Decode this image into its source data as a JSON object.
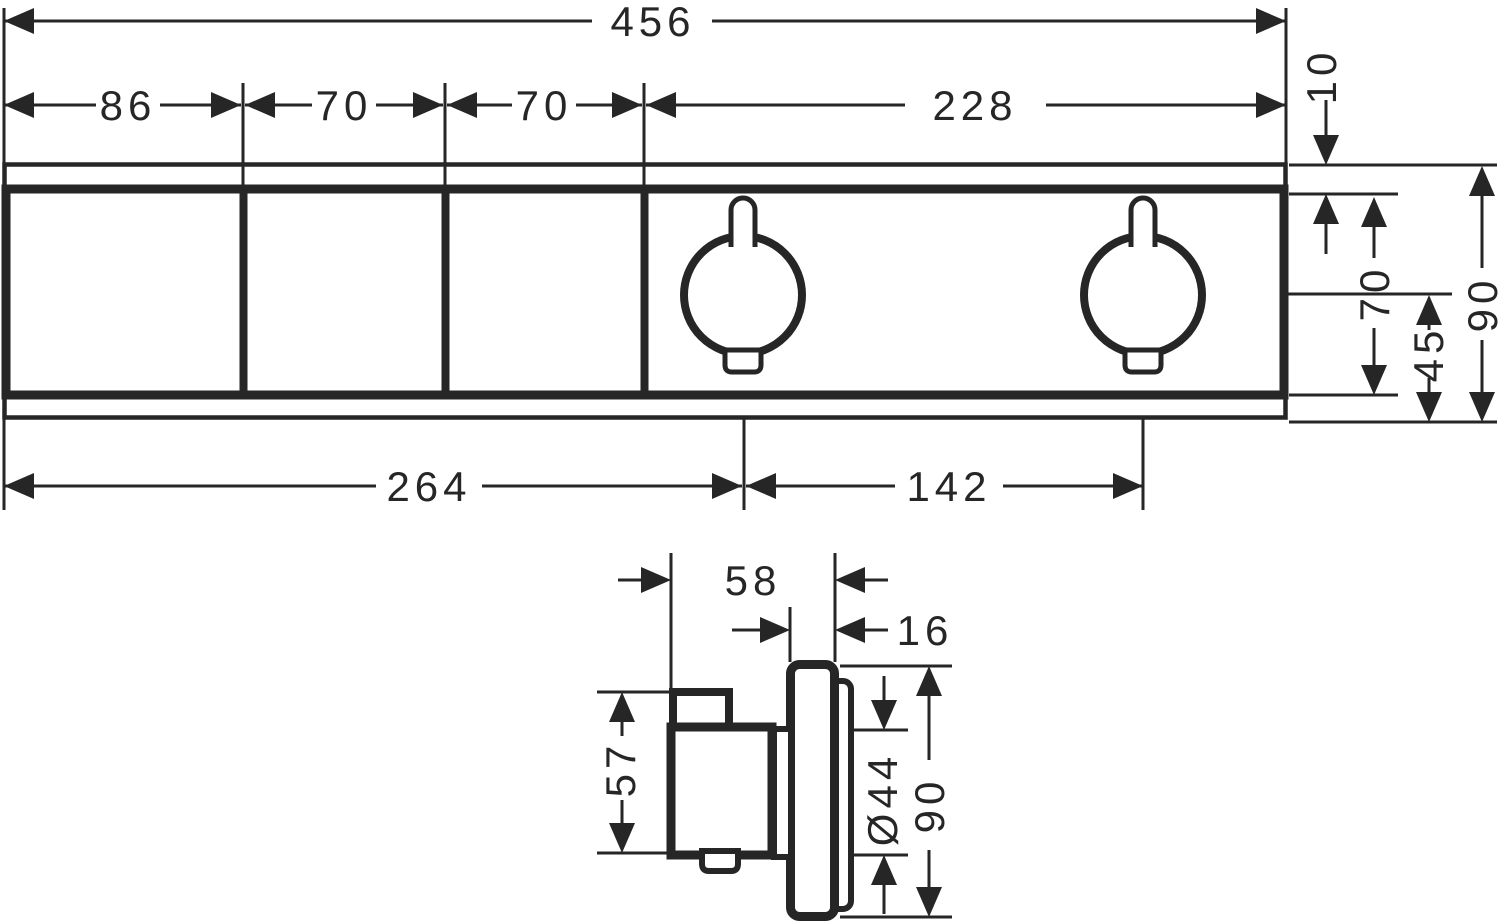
{
  "front_view": {
    "dims": {
      "overall_width": "456",
      "module_1_width": "86",
      "module_2_width": "70",
      "module_3_width": "70",
      "thermostat_section_width": "228",
      "top_inset": "10",
      "panel_height": "70",
      "center_to_bottom": "45",
      "overall_height": "90",
      "left_to_handle1_center": "264",
      "handle1_to_handle2_center": "142"
    }
  },
  "side_view": {
    "dims": {
      "total_projection": "58",
      "escutcheon_depth": "16",
      "handle_height": "57",
      "handle_diameter": "Ø44",
      "escutcheon_height": "90"
    }
  },
  "colors": {
    "line": "#262626",
    "background": "#ffffff"
  }
}
